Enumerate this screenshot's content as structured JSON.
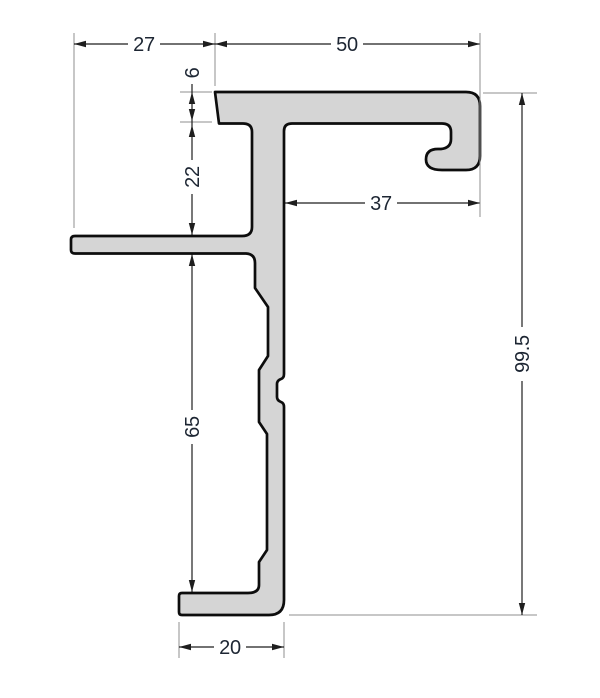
{
  "drawing": {
    "kind": "technical-cross-section-drawing",
    "part": "aluminium-profile-cross-section",
    "colors": {
      "background": "#ffffff",
      "profile_fill": "#d5d5d5",
      "profile_outline": "#0d0d0d",
      "dimension_line": "#1e1e1e",
      "extension_line": "#8f8f8f",
      "text": "#1d2633"
    },
    "dimensions": [
      {
        "id": "left-fin-overhang",
        "label": "27",
        "orientation": "horizontal"
      },
      {
        "id": "top-flange-width",
        "label": "50",
        "orientation": "horizontal"
      },
      {
        "id": "flange-thickness",
        "label": "6",
        "orientation": "vertical"
      },
      {
        "id": "flange-to-fin-gap",
        "label": "22",
        "orientation": "vertical"
      },
      {
        "id": "hook-offset-width",
        "label": "37",
        "orientation": "horizontal"
      },
      {
        "id": "fin-to-foot-height",
        "label": "65",
        "orientation": "vertical"
      },
      {
        "id": "overall-height",
        "label": "99.5",
        "orientation": "vertical"
      },
      {
        "id": "bottom-foot-width",
        "label": "20",
        "orientation": "horizontal"
      }
    ]
  }
}
